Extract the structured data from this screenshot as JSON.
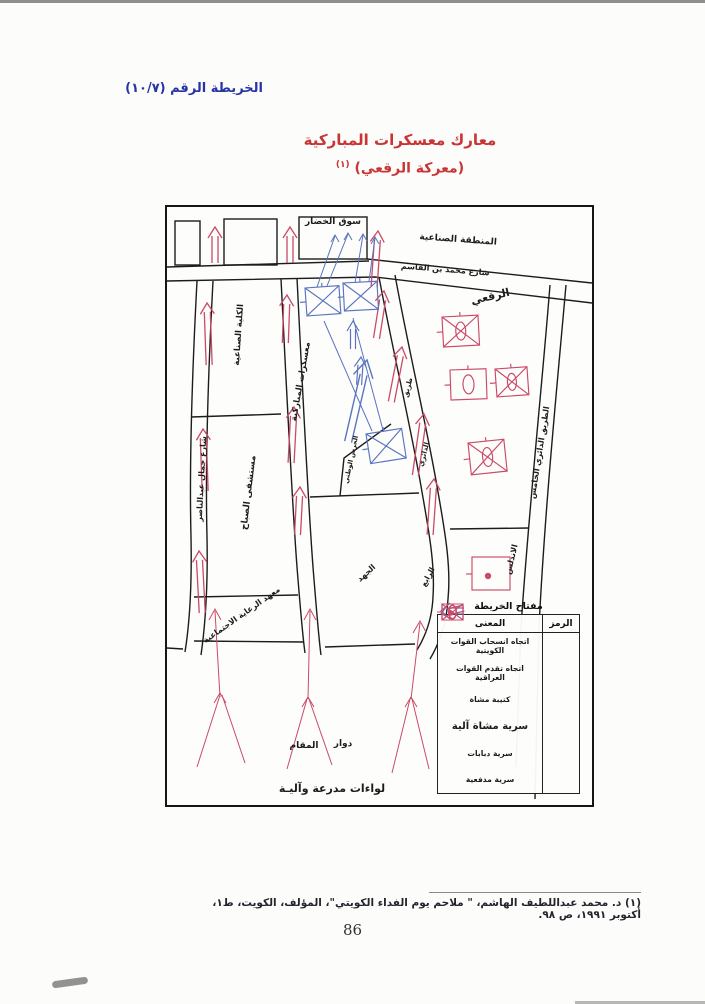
{
  "page": {
    "header_map_no": "الخريطة الرقم (١٠/٧)",
    "title_line1": "معارك معسكرات المباركية",
    "title_line2": "(معركة الرقعي)",
    "footnote_ref": "(١)",
    "footnote": "(١) د. محمد عبداللطيف الهاشم، \" ملاحم يوم الفداء الكويتي\"، المؤلف، الكويت، ط١، أكتوبر ١٩٩١، ص ٩٨.",
    "page_number": "86"
  },
  "map": {
    "labels": {
      "souq_market": "سوق الخضار",
      "industrial_zone": "المنطقة الصناعية",
      "qasim_street": "شارع محمد بن القاسم",
      "raqai": "الرقعي",
      "industrial_college": "الكلية الصناعية",
      "mubarakiya_camps": "معسكرات المباركية",
      "nasser_street": "شارع جمال عبدالناصر",
      "sabah_hospital": "مستشفى الصباح",
      "social_care_institute": "معهد الرعاية الاجتماعية",
      "national_guard": "الحرس الوطني",
      "road": "طريق",
      "ring": "الدائري",
      "fourth": "الرابع",
      "juhd": "الجهد",
      "andalus": "الاندلس",
      "fifth_ring_road": "الطريق الدائري الخامس",
      "maqam": "المقام",
      "roundabout": "دوار",
      "armored_brigades": "لواءات مدرعة وآليـة"
    },
    "legend": {
      "title": "مفتاح الخريطة",
      "col_symbol": "الرمز",
      "col_meaning": "المعنى",
      "rows": [
        {
          "symbol": "blue-withdraw-arrow",
          "meaning": "اتجاه انسحاب القوات الكويتية"
        },
        {
          "symbol": "red-advance-arrow",
          "meaning": "اتجاه تقدم القوات العراقية"
        },
        {
          "symbol": "infantry-battalion",
          "meaning": "كتيبة مشاة"
        },
        {
          "symbol": "mechanized-infantry-company",
          "meaning": "سرية مشاة آلية"
        },
        {
          "symbol": "tank-company",
          "meaning": "سرية دبابات"
        },
        {
          "symbol": "artillery-company",
          "meaning": "سرية مدفعية"
        }
      ]
    }
  },
  "colors": {
    "red": "#cb4a66",
    "blue": "#5a74bf",
    "title_red": "#c93434",
    "header_blue": "#2733a6",
    "ink": "#1c1c1c"
  }
}
